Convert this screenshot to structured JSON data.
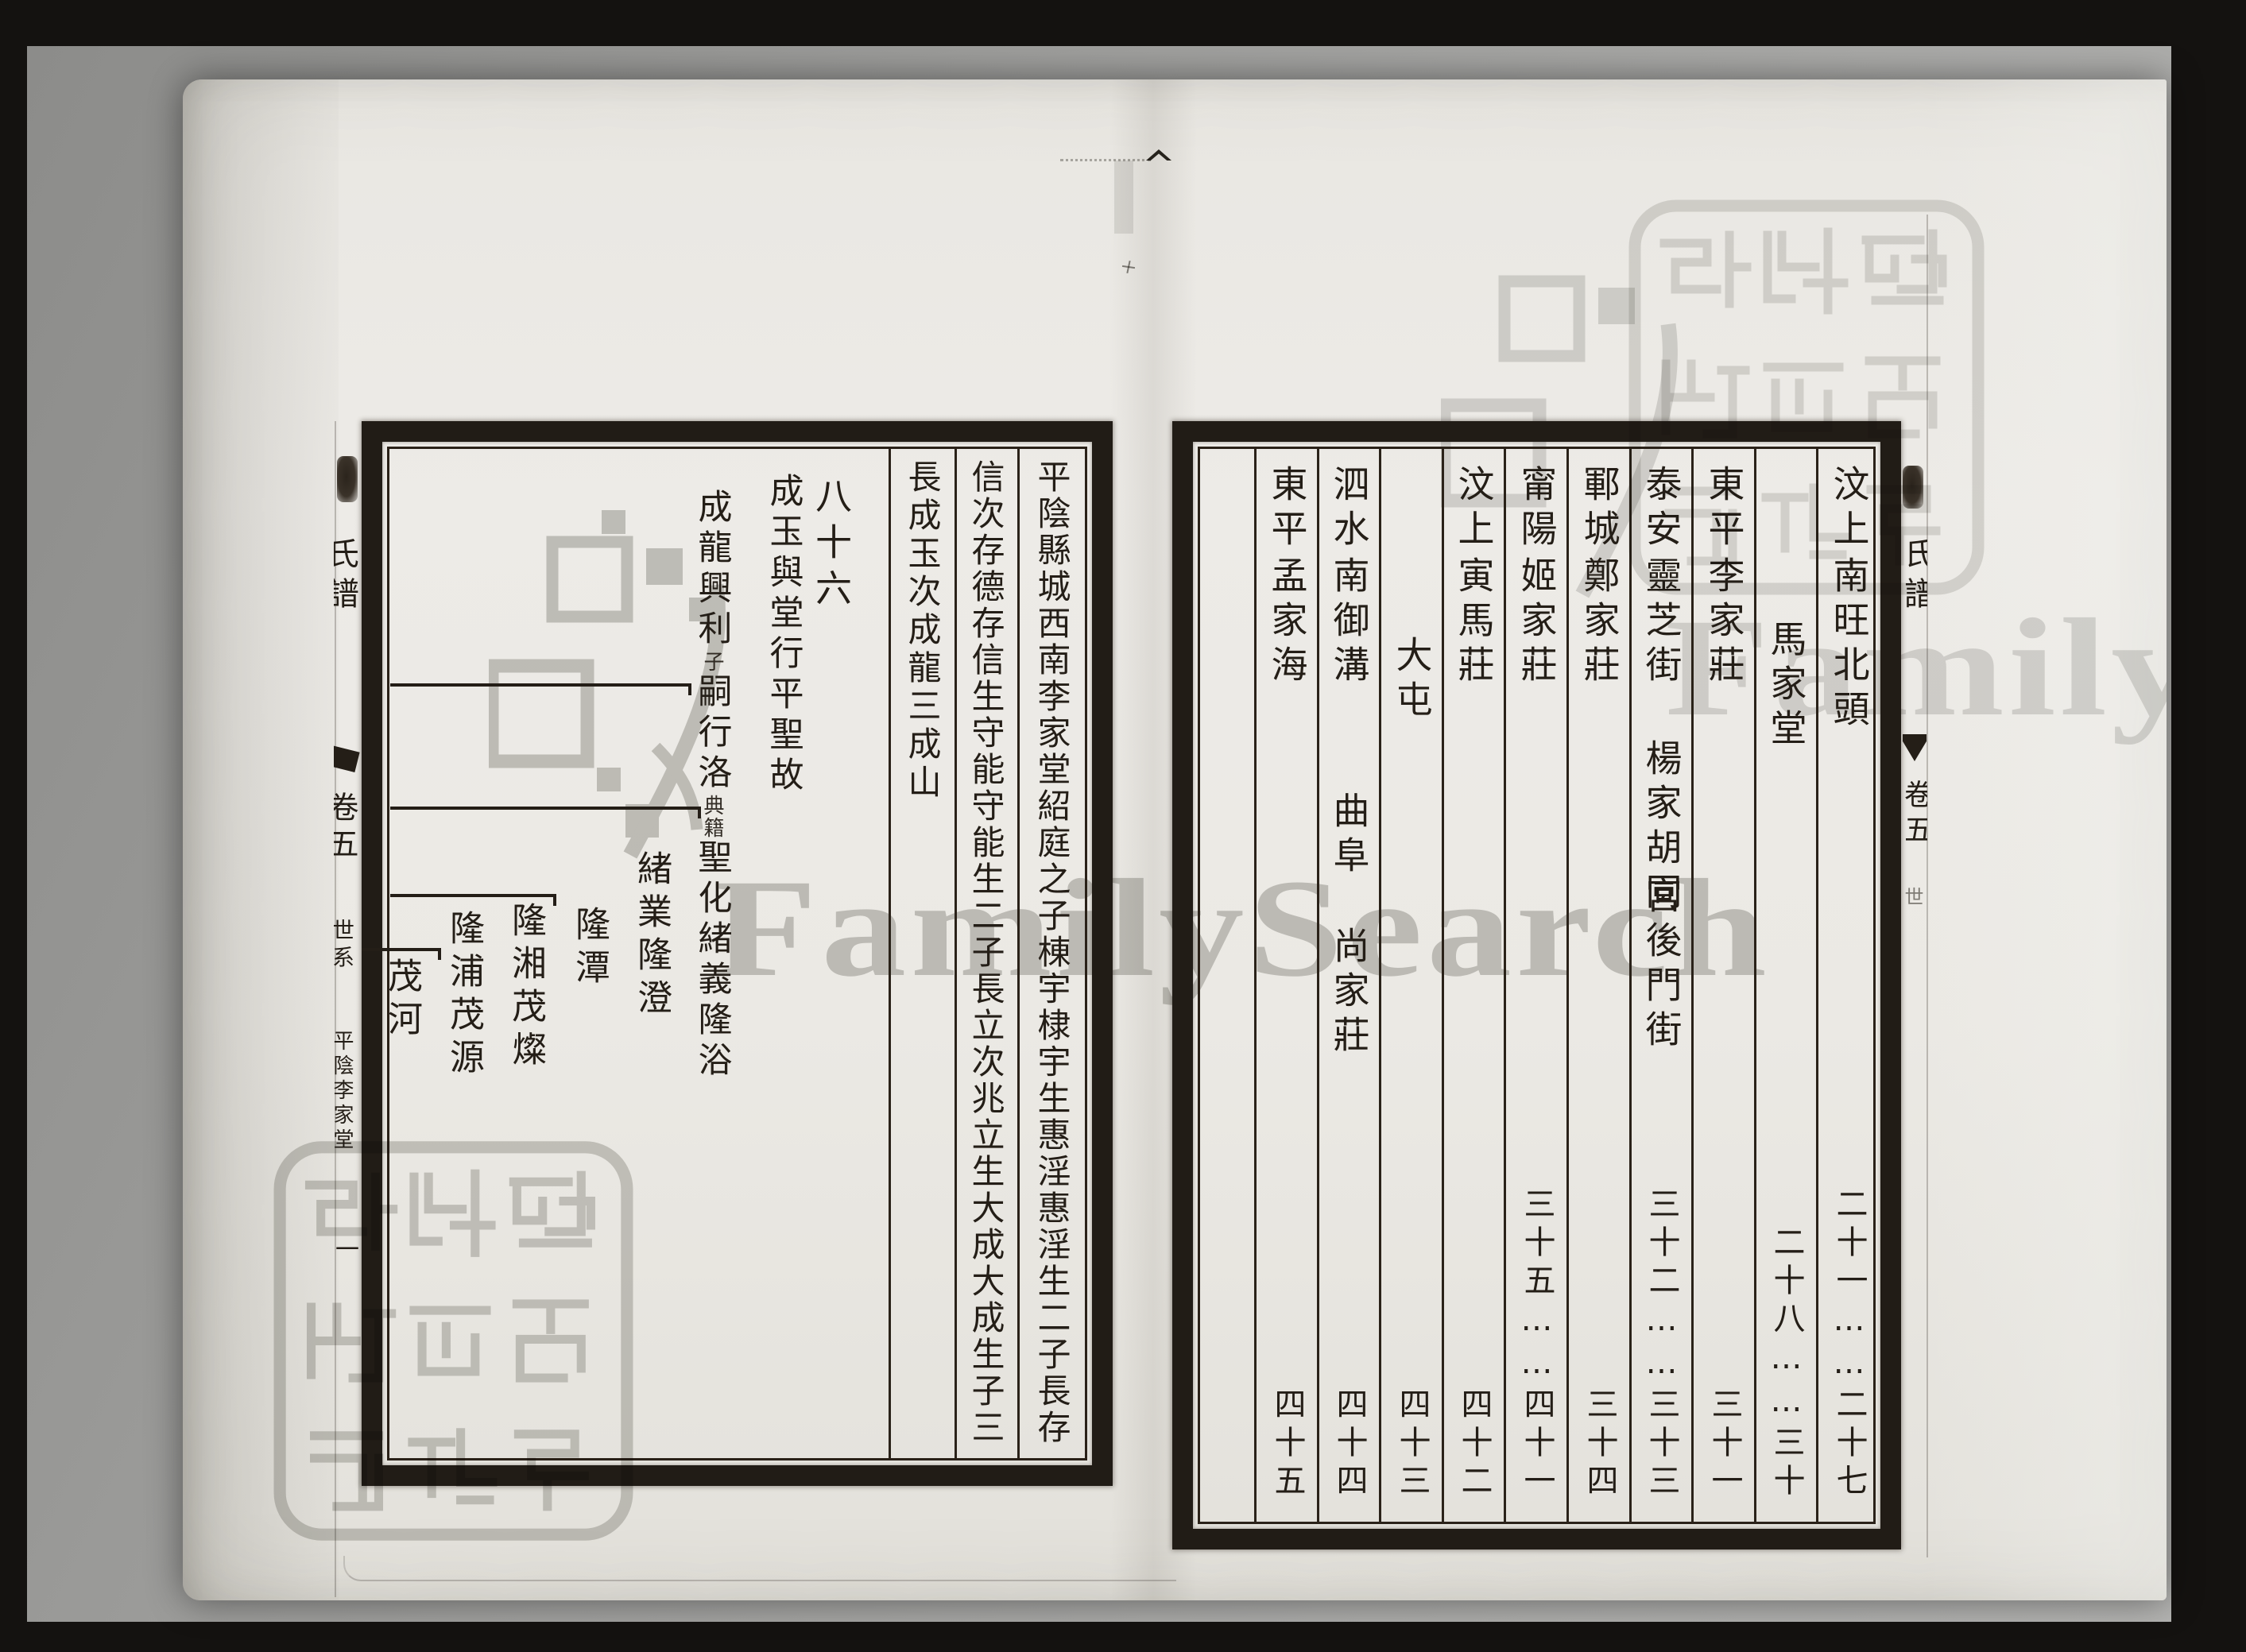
{
  "watermark": {
    "text": "FamilySearch",
    "logo": "familysearch-tree-logo",
    "color": "#bdbdba"
  },
  "seal": {
    "text": "猶他家譜學會攝製",
    "style": "seal-script 3x3 stamp",
    "color": "#cfcfcc"
  },
  "left_page": {
    "spine": {
      "title_visible": "氏譜",
      "volume": "卷五",
      "section": "世系",
      "imprint": "平陰李家堂",
      "folio": "一"
    },
    "text_columns": {
      "a": "平陰縣城西南李家堂紹庭之子棟宇棣宇生惠淫惠淫生二子長存",
      "b": "信次存德存信生守能守能生二子長立次兆立生大成大成生子三",
      "c": "長成玉次成龍三成山"
    },
    "generation": "八十六",
    "chart": {
      "note1": "成玉與堂行平聖故",
      "note2_head": "成龍興利",
      "note2_small1": "子",
      "note2_mid": "嗣行洛",
      "note2_small2": "典籍",
      "note2_tail": "聖化緒義隆浴",
      "name1": "緒業隆澄",
      "name2": "隆潭",
      "name3": "隆湘茂燦",
      "name4": "隆浦茂源",
      "name5": "茂河"
    }
  },
  "right_page": {
    "spine": {
      "title_visible": "氏譜",
      "volume": "卷五",
      "section": "世"
    },
    "columns": [
      {
        "region": "汶上",
        "e1": "南旺北頭",
        "pages": "二十一……二十七"
      },
      {
        "region": "",
        "e1": "馬家堂",
        "pages": "二十八……三十"
      },
      {
        "region": "東平",
        "e1": "李家莊",
        "pages": "三十一"
      },
      {
        "region": "泰安",
        "e1": "靈芝街",
        "e2": "楊家胡同",
        "e3": "宮後門街",
        "pages": "三十二……三十三"
      },
      {
        "region": "鄆城",
        "e1": "鄭家莊",
        "pages": "三十四"
      },
      {
        "region": "甯陽",
        "e1": "姬家莊",
        "pages": "三十五……四十一"
      },
      {
        "region": "汶上",
        "e1": "寅馬莊",
        "pages": "四十二"
      },
      {
        "region": "",
        "e1": "大屯",
        "pages": "四十三"
      },
      {
        "region": "泗水",
        "e1": "南御溝",
        "e2": "曲阜",
        "e3": "尚家莊",
        "pages": "四十四"
      },
      {
        "region": "東平",
        "e1": "孟家海",
        "pages": "四十五"
      },
      {
        "region": "",
        "e1": "",
        "pages": ""
      }
    ]
  }
}
